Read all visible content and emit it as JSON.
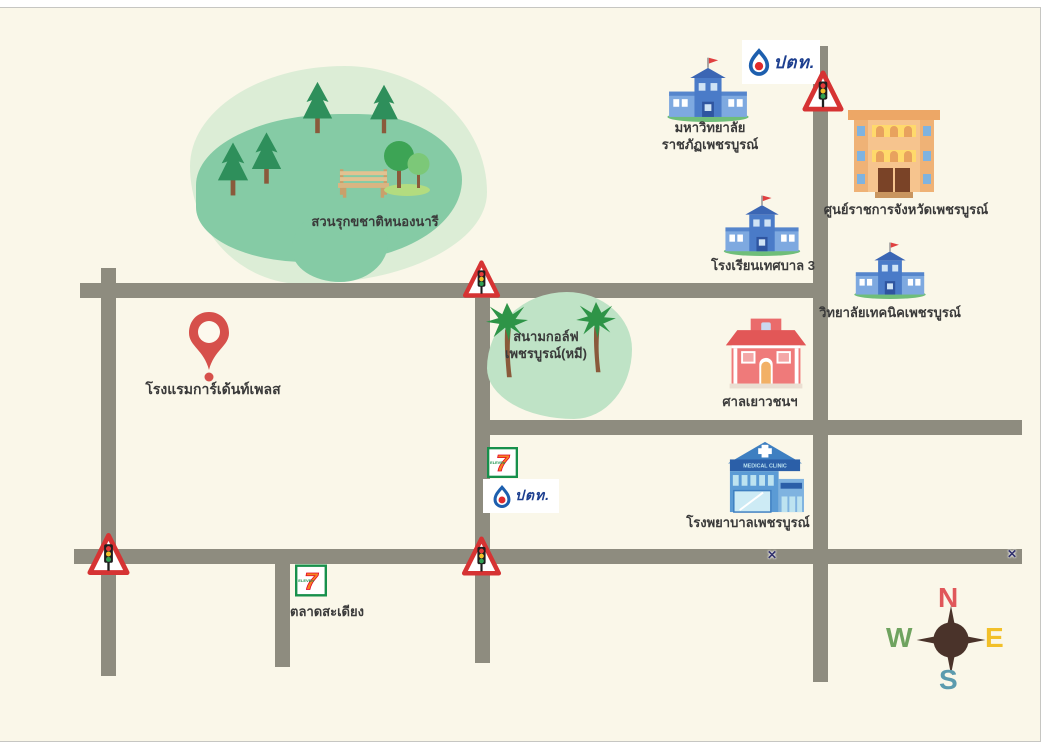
{
  "places": {
    "park": {
      "label": "สวนรุกขชาติหนองนารี"
    },
    "golf": {
      "label_line1": "สนามกอล์ฟ",
      "label_line2": "เพชรบูรณ์(หมี)"
    },
    "university": {
      "label_line1": "มหาวิทยาลัย",
      "label_line2": "ราชภัฏเพชรบูรณ์"
    },
    "government_center": {
      "label": "ศูนย์ราชการจังหวัดเพชรบูรณ์"
    },
    "school": {
      "label": "โรงเรียนเทศบาล 3"
    },
    "technical_college": {
      "label": "วิทยาลัยเทคนิคเพชรบูรณ์"
    },
    "juvenile_court": {
      "label": "ศาลเยาวชนฯ"
    },
    "hospital": {
      "label": "โรงพยาบาลเพชรบูรณ์",
      "sign": "MEDICAL CLINIC"
    },
    "hotel": {
      "label": "โรงแรมการ์เด้นท์เพลส"
    },
    "market": {
      "label": "ตลาดสะเดียง"
    }
  },
  "logos": {
    "ptt": {
      "text": "ปตท."
    },
    "seven_eleven": {
      "digit": "7",
      "word": "ELEVEn"
    }
  },
  "compass": {
    "north": "N",
    "east": "E",
    "west": "W",
    "south": "S",
    "north_color": "#E0575A",
    "east_color": "#F2C029",
    "west_color": "#6FA35F",
    "south_color": "#5B9BAE"
  },
  "markers": {
    "cross": "✕"
  },
  "colors": {
    "background": "#FAF7E9",
    "road": "#8E8C7F",
    "park_light": "#DCEDD6",
    "park_dark": "#85CBA5",
    "golf_green": "#BFE3C6",
    "pin_red": "#D6504B",
    "warning_sign_red": "#D63333",
    "label_text": "#3A3A3A"
  }
}
